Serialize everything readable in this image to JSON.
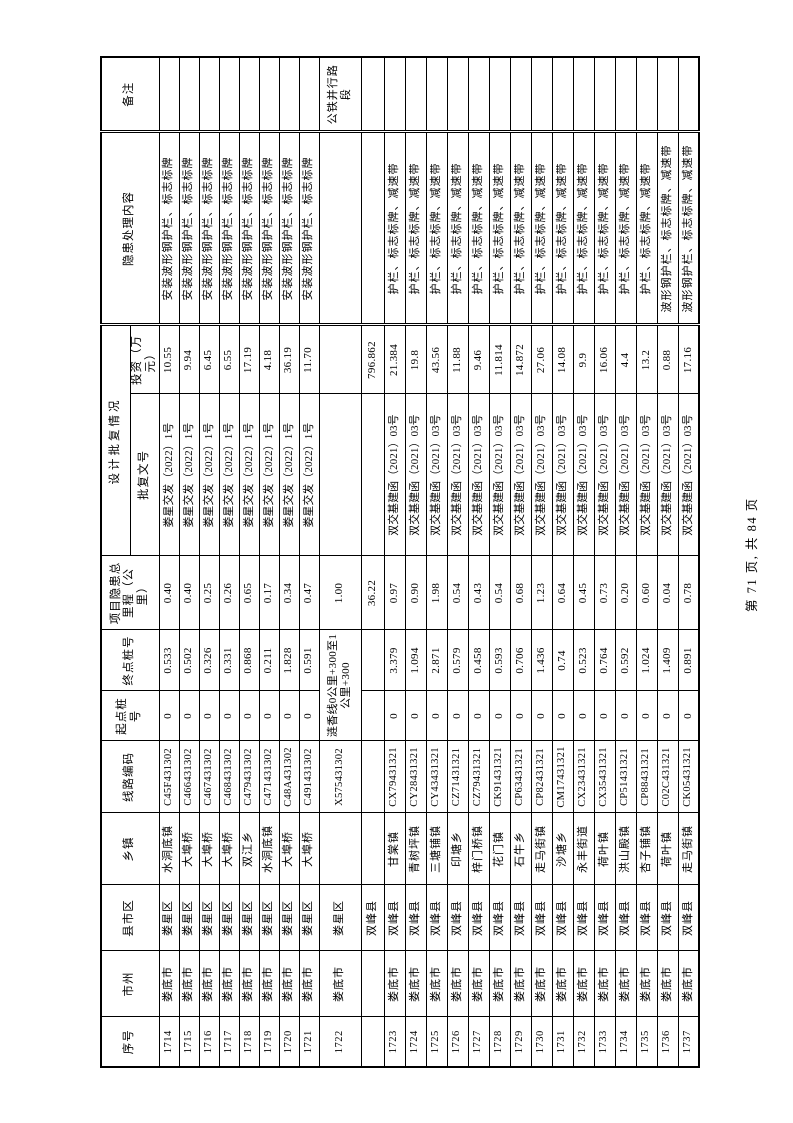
{
  "page": {
    "footer": "第 71 页, 共 84 页"
  },
  "table": {
    "columns": [
      "序号",
      "市州",
      "县市区",
      "乡镇",
      "线路编码",
      "起点桩号",
      "终点桩号",
      "项目隐患总里程（公里）",
      "批复文号",
      "投资（万元）",
      "隐患处理内容",
      "备注"
    ],
    "group_header": {
      "label": "设计批复情况",
      "span_start": 8,
      "span_count": 2
    },
    "rows": [
      {
        "h": "n",
        "cells": [
          "1714",
          "娄底市",
          "娄星区",
          "水洞底镇",
          "C45F431302",
          "0",
          "0.533",
          "0.40",
          "娄星交发（2022）1号",
          "10.55",
          "安装波形钢护栏、标志标牌",
          ""
        ]
      },
      {
        "h": "n",
        "cells": [
          "1715",
          "娄底市",
          "娄星区",
          "大埠桥",
          "C466431302",
          "0",
          "0.502",
          "0.40",
          "娄星交发（2022）1号",
          "9.94",
          "安装波形钢护栏、标志标牌",
          ""
        ]
      },
      {
        "h": "n",
        "cells": [
          "1716",
          "娄底市",
          "娄星区",
          "大埠桥",
          "C467431302",
          "0",
          "0.326",
          "0.25",
          "娄星交发（2022）1号",
          "6.45",
          "安装波形钢护栏、标志标牌",
          ""
        ]
      },
      {
        "h": "n",
        "cells": [
          "1717",
          "娄底市",
          "娄星区",
          "大埠桥",
          "C468431302",
          "0",
          "0.331",
          "0.26",
          "娄星交发（2022）1号",
          "6.55",
          "安装波形钢护栏、标志标牌",
          ""
        ]
      },
      {
        "h": "n",
        "cells": [
          "1718",
          "娄底市",
          "娄星区",
          "双江乡",
          "C479431302",
          "0",
          "0.868",
          "0.65",
          "娄星交发（2022）1号",
          "17.19",
          "安装波形钢护栏、标志标牌",
          ""
        ]
      },
      {
        "h": "n",
        "cells": [
          "1719",
          "娄底市",
          "娄星区",
          "水洞底镇",
          "C471431302",
          "0",
          "0.211",
          "0.17",
          "娄星交发（2022）1号",
          "4.18",
          "安装波形钢护栏、标志标牌",
          ""
        ]
      },
      {
        "h": "n",
        "cells": [
          "1720",
          "娄底市",
          "娄星区",
          "大埠桥",
          "C48A431302",
          "0",
          "1.828",
          "0.34",
          "娄星交发（2022）1号",
          "36.19",
          "安装波形钢护栏、标志标牌",
          ""
        ]
      },
      {
        "h": "n",
        "cells": [
          "1721",
          "娄底市",
          "娄星区",
          "大埠桥",
          "C491431302",
          "0",
          "0.591",
          "0.47",
          "娄星交发（2022）1号",
          "11.70",
          "安装波形钢护栏、标志标牌",
          ""
        ]
      },
      {
        "h": "w",
        "cells": [
          "1722",
          "娄底市",
          "娄星区",
          "",
          "X575431302",
          {
            "v": "涟香线0公里+300至1公里+300",
            "span": 2
          },
          "1.00",
          "",
          "",
          "",
          "公铁并行路段"
        ]
      },
      {
        "h": "s",
        "cells": [
          "",
          "",
          "双峰县",
          "",
          "",
          "",
          "",
          "36.22",
          "",
          "796.862",
          "",
          ""
        ]
      },
      {
        "h": "t",
        "cells": [
          "1723",
          "娄底市",
          "双峰县",
          "甘棠镇",
          "CX79431321",
          "0",
          "3.379",
          "0.97",
          "双交基建函（2021）03号",
          "21.384",
          "护栏、标志标牌、减速带",
          ""
        ]
      },
      {
        "h": "t",
        "cells": [
          "1724",
          "娄底市",
          "双峰县",
          "青树坪镇",
          "CY28431321",
          "0",
          "1.094",
          "0.90",
          "双交基建函（2021）03号",
          "19.8",
          "护栏、标志标牌、减速带",
          ""
        ]
      },
      {
        "h": "t",
        "cells": [
          "1725",
          "娄底市",
          "双峰县",
          "三塘铺镇",
          "CY43431321",
          "0",
          "2.871",
          "1.98",
          "双交基建函（2021）03号",
          "43.56",
          "护栏、标志标牌、减速带",
          ""
        ]
      },
      {
        "h": "t",
        "cells": [
          "1726",
          "娄底市",
          "双峰县",
          "印塘乡",
          "CZ71431321",
          "0",
          "0.579",
          "0.54",
          "双交基建函（2021）03号",
          "11.88",
          "护栏、标志标牌、减速带",
          ""
        ]
      },
      {
        "h": "t",
        "cells": [
          "1727",
          "娄底市",
          "双峰县",
          "梓门桥镇",
          "CZ79431321",
          "0",
          "0.458",
          "0.43",
          "双交基建函（2021）03号",
          "9.46",
          "护栏、标志标牌、减速带",
          ""
        ]
      },
      {
        "h": "t",
        "cells": [
          "1728",
          "娄底市",
          "双峰县",
          "花门镇",
          "CK91431321",
          "0",
          "0.593",
          "0.54",
          "双交基建函（2021）03号",
          "11.814",
          "护栏、标志标牌、减速带",
          ""
        ]
      },
      {
        "h": "t",
        "cells": [
          "1729",
          "娄底市",
          "双峰县",
          "石牛乡",
          "CP63431321",
          "0",
          "0.706",
          "0.68",
          "双交基建函（2021）03号",
          "14.872",
          "护栏、标志标牌、减速带",
          ""
        ]
      },
      {
        "h": "t",
        "cells": [
          "1730",
          "娄底市",
          "双峰县",
          "走马街镇",
          "CP82431321",
          "0",
          "1.436",
          "1.23",
          "双交基建函（2021）03号",
          "27.06",
          "护栏、标志标牌、减速带",
          ""
        ]
      },
      {
        "h": "t",
        "cells": [
          "1731",
          "娄底市",
          "双峰县",
          "沙塘乡",
          "CM17431321",
          "0",
          "0.74",
          "0.64",
          "双交基建函（2021）03号",
          "14.08",
          "护栏、标志标牌、减速带",
          ""
        ]
      },
      {
        "h": "t",
        "cells": [
          "1732",
          "娄底市",
          "双峰县",
          "永丰街道",
          "CX23431321",
          "0",
          "0.523",
          "0.45",
          "双交基建函（2021）03号",
          "9.9",
          "护栏、标志标牌、减速带",
          ""
        ]
      },
      {
        "h": "t",
        "cells": [
          "1733",
          "娄底市",
          "双峰县",
          "荷叶镇",
          "CX35431321",
          "0",
          "0.764",
          "0.73",
          "双交基建函（2021）03号",
          "16.06",
          "护栏、标志标牌、减速带",
          ""
        ]
      },
      {
        "h": "t",
        "cells": [
          "1734",
          "娄底市",
          "双峰县",
          "洪山殿镇",
          "CP51431321",
          "0",
          "0.592",
          "0.20",
          "双交基建函（2021）03号",
          "4.4",
          "护栏、标志标牌、减速带",
          ""
        ]
      },
      {
        "h": "t",
        "cells": [
          "1735",
          "娄底市",
          "双峰县",
          "杏子铺镇",
          "CP88431321",
          "0",
          "1.024",
          "0.60",
          "双交基建函（2021）03号",
          "13.2",
          "护栏、标志标牌、减速带",
          ""
        ]
      },
      {
        "h": "t",
        "cells": [
          "1736",
          "娄底市",
          "双峰县",
          "荷叶镇",
          "C02C431321",
          "0",
          "1.409",
          "0.04",
          "双交基建函（2021）03号",
          "0.88",
          "波形钢护栏、标志标牌、减速带",
          ""
        ]
      },
      {
        "h": "t",
        "cells": [
          "1737",
          "娄底市",
          "双峰县",
          "走马街镇",
          "CK05431321",
          "0",
          "0.891",
          "0.78",
          "双交基建函（2021）03号",
          "17.16",
          "波形钢护栏、标志标牌、减速带",
          ""
        ]
      }
    ]
  }
}
